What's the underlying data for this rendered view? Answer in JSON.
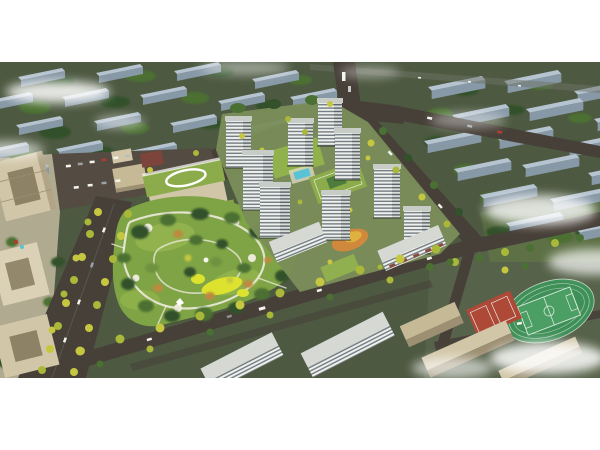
{
  "image": {
    "type": "aerial-architectural-rendering",
    "description": "Bird's-eye architectural rendering of a residential development: white high-rise apartment towers around landscaped courtyards with a pool and playgrounds, a large central park with winding white paths and a bright yellow playground, a kindergarten with a green roof and oval rooftop ring, a tree-lined boulevard, cream office towers, street-front commercial slabs along a diagonal road, and a school campus with a green sports field and red courts, all surrounded by rows of blue-grey background buildings, dark roads and drifting white clouds. White margins above and below the rendering."
  },
  "scene": {
    "parts": [
      "background-building-rows",
      "ring-roads",
      "tree-lined-boulevard",
      "office-towers",
      "parking-lot",
      "kindergarten",
      "central-park",
      "park-paths",
      "park-playground",
      "residential-towers",
      "courtyard-gardens",
      "swimming-pool",
      "street-front-commercial-slab",
      "south-residential-slabs",
      "school-campus",
      "sports-field",
      "basketball-courts",
      "street-trees",
      "vehicles",
      "clouds"
    ]
  },
  "colors": {
    "page-bg": "#ffffff",
    "ground": "#4d5941",
    "ground-campus": "#57624a",
    "courtyard": "#7a8e5a",
    "plaza": "#d8cdb2",
    "tree-dark": "#33512a",
    "tree-mid": "#4b7033",
    "tree-light": "#6e9340",
    "park-base": "#7fa445",
    "park-lawn": "#94b54d",
    "path-white": "#ece9da",
    "playground-yellow": "#dde22e",
    "autumn": "#bd8a3f",
    "street-tree": "#c6c740",
    "street-tree-2": "#a9b838",
    "road": "#474038",
    "road-light": "#6d7265",
    "parking": "#544c43",
    "bg-roof": "#b6c4d1",
    "bg-side": "#8798a6",
    "tower-face": "#eef0ec",
    "tower-stripe": "#747c84",
    "tower-side": "#d7dad5",
    "tower-stripe-dark": "#596169",
    "tower-roof": "#c7ccc7",
    "slab-roof": "#d6d9d3",
    "cream": "#d2c6a8",
    "cream-2": "#c5b996",
    "cream-dark": "#9c8f72",
    "red-block": "#7c443a",
    "green-roof": "#8cab4b",
    "court-green": "#4e7c3c",
    "podium-orange": "#d0893c",
    "podium-orange-2": "#e0b13e",
    "pool": "#59c3d5",
    "field": "#3f8f58",
    "field-2": "#4c9f64",
    "field-line": "#dcebdd",
    "court-red": "#ad4936",
    "white": "#ffffff",
    "car": "#f4f4ef",
    "car-red": "#b13a2e"
  }
}
